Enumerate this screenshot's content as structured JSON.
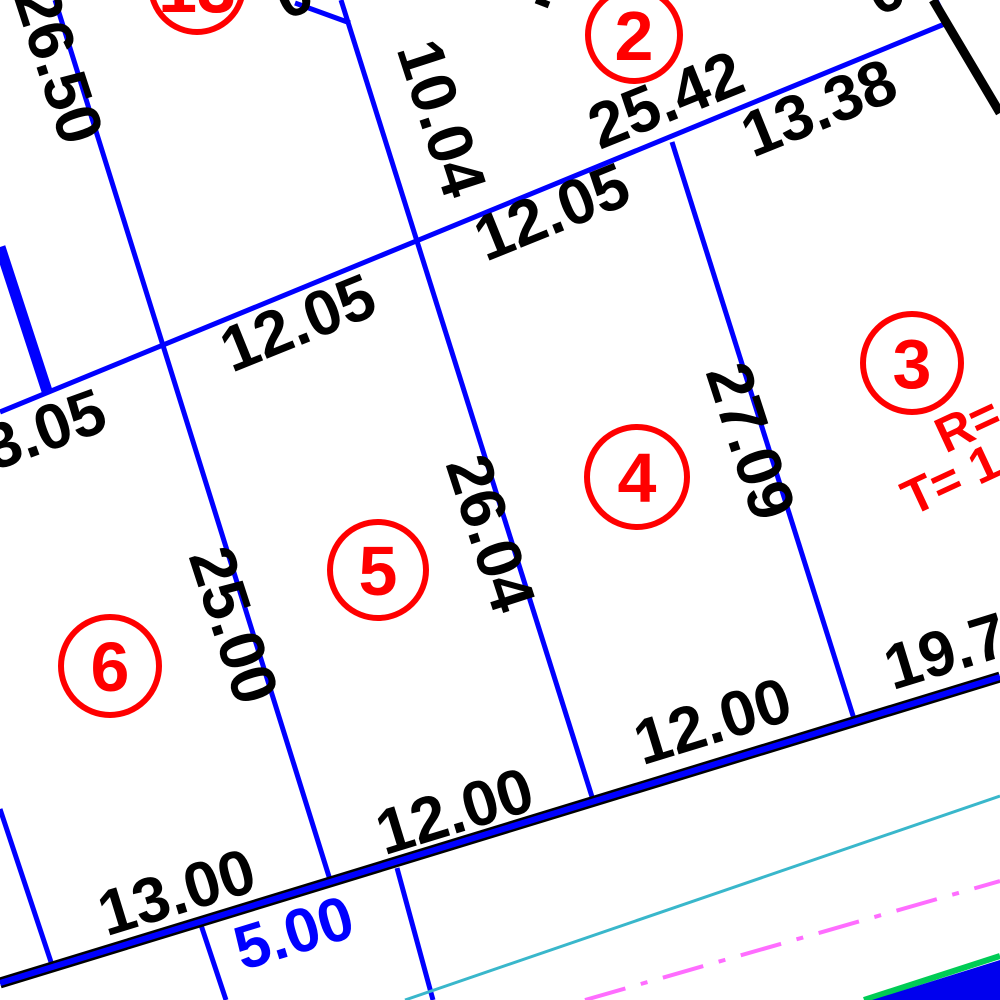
{
  "drawing": {
    "description_label": "subdivision plat detail view",
    "background": "#ffffff"
  },
  "colors": {
    "lot_line_blue": "#0000ff",
    "dimension_text_black": "#000000",
    "lot_marker_red": "#ff0000",
    "boundary_black": "#000000",
    "road_casing_black": "#000000",
    "road_core_blue": "#0000ff",
    "utility_cyan": "#39b7cb",
    "centerline_magenta": "#ff6dff",
    "utility_green": "#00cc55",
    "corner_fill_blue": "#0000ee"
  },
  "lots": {
    "lot13": {
      "number": "13"
    },
    "lot2": {
      "number": "2"
    },
    "lot3": {
      "number": "3",
      "curve_radius_label": "R=",
      "curve_tangent_label": "T= 1"
    },
    "lot4": {
      "number": "4"
    },
    "lot5": {
      "number": "5"
    },
    "lot6": {
      "number": "6"
    }
  },
  "dimensions": {
    "d_26_50": "26.50",
    "d_10_04": "10.04",
    "d_25_42": "25.42",
    "d_13_38": "13.38",
    "d_12_05_upper": "12.05",
    "d_12_05_lower": "12.05",
    "d_3_05": "3.05",
    "d_27_09": "27.09",
    "d_26_04": "26.04",
    "d_25_00": "25.00",
    "d_19_7": "19.7",
    "d_12_00_right": "12.00",
    "d_12_00_left": "12.00",
    "d_13_00": "13.00",
    "d_5_00": "5.00",
    "partial_top_left": "0",
    "partial_top_right": "0"
  }
}
